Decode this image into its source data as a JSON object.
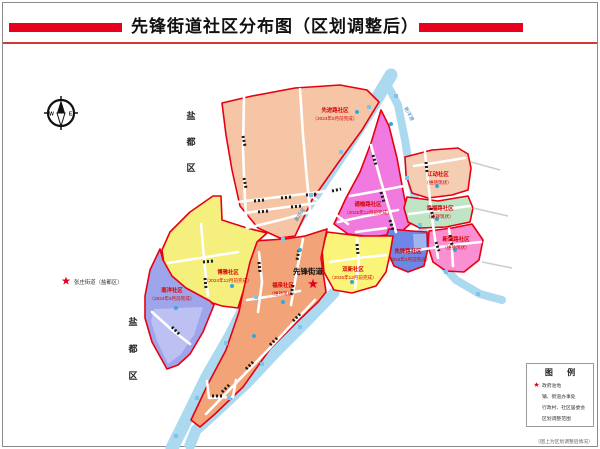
{
  "title": "先锋街道社区分布图（区划调整后）",
  "compass": {
    "west": "W",
    "east": "E"
  },
  "margin": {
    "yandu_top": [
      "盐",
      "都",
      "区"
    ],
    "yandu_bottom": [
      "盐",
      "都",
      "区"
    ],
    "neighbor_star_label": "张庄街道（盐都区）"
  },
  "map": {
    "center_label": "先锋街道",
    "river_labels": [
      "新洋港",
      "串场河"
    ],
    "regions": [
      {
        "name": "先进路社区",
        "note": "（2024年6月前完成）",
        "color": "#f5c5a5"
      },
      {
        "name": "通榆路社区",
        "note": "（2025年12月前完成）",
        "color": "#f07adf"
      },
      {
        "name": "江动社区",
        "note": "（维持现状）",
        "color": "#f5cdb2"
      },
      {
        "name": "幸福路社区",
        "note": "（维持现状）",
        "color": "#bfe5c5"
      },
      {
        "name": "新城路社区",
        "note": "（维持现状）",
        "color": "#fa8fd2"
      },
      {
        "name": "先锋路社区",
        "note": "（2024年4月前完成）",
        "color": "#6e86e6"
      },
      {
        "name": "双新社区",
        "note": "（2025年12月前完成）",
        "color": "#faf478"
      },
      {
        "name": "福泉社区",
        "note": "（维持现状）",
        "color": "#f2a478"
      },
      {
        "name": "博雅社区",
        "note": "（2024年12月前完成）",
        "color": "#f5ef7e"
      },
      {
        "name": "南洋社区",
        "note": "（2024年6月前完成）",
        "color": "#9fa5ea"
      }
    ]
  },
  "legend": {
    "title": "图 例",
    "items": [
      {
        "symbol": "star-red",
        "label": "政府驻地"
      },
      {
        "symbol": "dot-red",
        "label": "镇、街道办事处"
      },
      {
        "symbol": "dot-blue",
        "label": "行政村、社区居委会"
      },
      {
        "symbol": "line-red",
        "label": "区划调整范围"
      }
    ]
  },
  "caption": "（图上为区划调整后情况）",
  "colors": {
    "boundary": "#e60012",
    "river": "#abd9f0",
    "river_marker": "#7ec3ea",
    "title_red": "#e8001f",
    "blue_dot": "#29abe2"
  }
}
